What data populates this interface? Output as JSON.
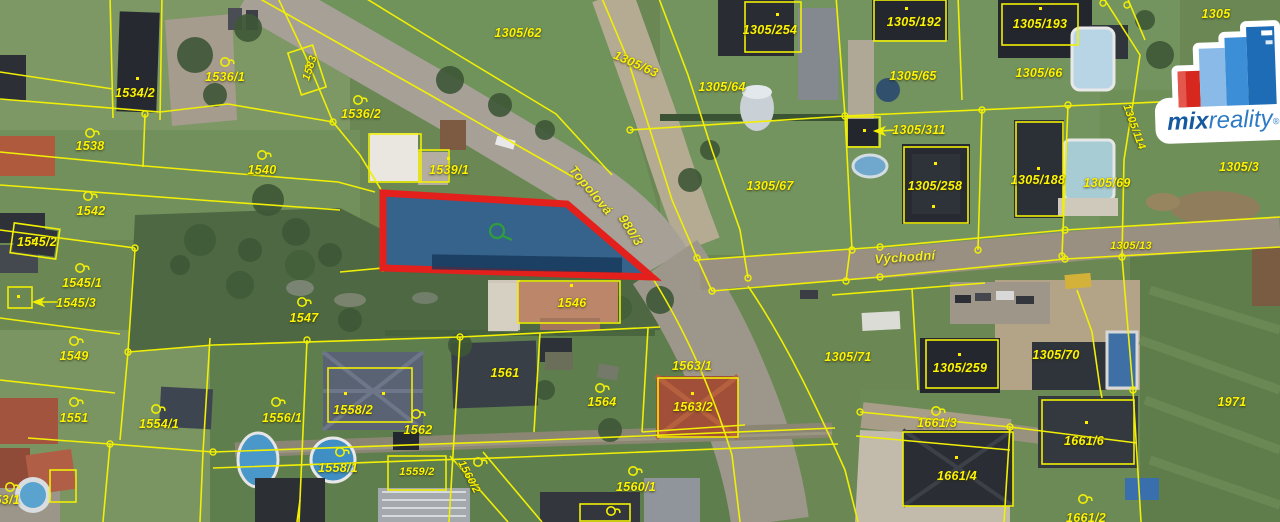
{
  "map": {
    "description": "Aerial cadastral map with parcel boundaries and one highlighted parcel",
    "highlighted_parcel": {
      "border_color": "#e3201b",
      "fill_color": "#2e5f93",
      "marker_color": "#2f9e3c"
    },
    "colors": {
      "parcel_line": "#f0ef05",
      "label": "#fdf304"
    },
    "street_names": [
      "Topolová",
      "Východní"
    ],
    "labels": [
      {
        "text": "1534/2",
        "x": 135,
        "y": 93
      },
      {
        "text": "1536/1",
        "x": 225,
        "y": 77
      },
      {
        "text": "1536/2",
        "x": 361,
        "y": 114
      },
      {
        "text": "1583",
        "x": 310,
        "y": 68,
        "rot": -72,
        "size": 11
      },
      {
        "text": "1538",
        "x": 90,
        "y": 146
      },
      {
        "text": "1540",
        "x": 262,
        "y": 170
      },
      {
        "text": "1542",
        "x": 91,
        "y": 211
      },
      {
        "text": "1545/2",
        "x": 37,
        "y": 242
      },
      {
        "text": "1545/1",
        "x": 82,
        "y": 283
      },
      {
        "text": "1545/3",
        "x": 76,
        "y": 303
      },
      {
        "text": "1549",
        "x": 74,
        "y": 356
      },
      {
        "text": "1551",
        "x": 74,
        "y": 418
      },
      {
        "text": "1554/1",
        "x": 159,
        "y": 424
      },
      {
        "text": "1553/1",
        "x": 0,
        "y": 500
      },
      {
        "text": "1556/1",
        "x": 282,
        "y": 418
      },
      {
        "text": "1558/2",
        "x": 353,
        "y": 410
      },
      {
        "text": "1558/1",
        "x": 338,
        "y": 468
      },
      {
        "text": "1562",
        "x": 418,
        "y": 430
      },
      {
        "text": "1561",
        "x": 505,
        "y": 373
      },
      {
        "text": "1559/2",
        "x": 417,
        "y": 472,
        "size": 11
      },
      {
        "text": "1560/2",
        "x": 469,
        "y": 477,
        "rot": 62,
        "size": 11
      },
      {
        "text": "1560/1",
        "x": 636,
        "y": 487
      },
      {
        "text": "1564",
        "x": 602,
        "y": 402
      },
      {
        "text": "1563/1",
        "x": 692,
        "y": 366
      },
      {
        "text": "1563/2",
        "x": 693,
        "y": 407
      },
      {
        "text": "1546",
        "x": 572,
        "y": 303
      },
      {
        "text": "1547",
        "x": 304,
        "y": 318
      },
      {
        "text": "1539/1",
        "x": 449,
        "y": 170
      },
      {
        "text": "1305/62",
        "x": 518,
        "y": 33
      },
      {
        "text": "1305/63",
        "x": 636,
        "y": 64,
        "rot": 24
      },
      {
        "text": "1305/254",
        "x": 770,
        "y": 30
      },
      {
        "text": "1305/192",
        "x": 914,
        "y": 22
      },
      {
        "text": "1305/64",
        "x": 722,
        "y": 87
      },
      {
        "text": "1305/65",
        "x": 913,
        "y": 76
      },
      {
        "text": "1305/311",
        "x": 919,
        "y": 130
      },
      {
        "text": "1305/193",
        "x": 1040,
        "y": 24
      },
      {
        "text": "1305/66",
        "x": 1039,
        "y": 73
      },
      {
        "text": "1305",
        "x": 1216,
        "y": 14
      },
      {
        "text": "1305/67",
        "x": 770,
        "y": 186
      },
      {
        "text": "1305/258",
        "x": 935,
        "y": 186
      },
      {
        "text": "1305/188",
        "x": 1038,
        "y": 180
      },
      {
        "text": "1305/69",
        "x": 1107,
        "y": 183
      },
      {
        "text": "1305/3",
        "x": 1239,
        "y": 167
      },
      {
        "text": "1305/13",
        "x": 1131,
        "y": 246,
        "size": 11
      },
      {
        "text": "1305/114",
        "x": 1134,
        "y": 127,
        "rot": 70,
        "size": 11
      },
      {
        "text": "1305/71",
        "x": 848,
        "y": 357
      },
      {
        "text": "1305/259",
        "x": 960,
        "y": 368
      },
      {
        "text": "1305/70",
        "x": 1056,
        "y": 355
      },
      {
        "text": "1661/3",
        "x": 937,
        "y": 423
      },
      {
        "text": "1661/4",
        "x": 957,
        "y": 476
      },
      {
        "text": "1661/6",
        "x": 1084,
        "y": 441
      },
      {
        "text": "1661/2",
        "x": 1086,
        "y": 518
      },
      {
        "text": "1971",
        "x": 1232,
        "y": 402
      },
      {
        "text": "Topolová",
        "x": 591,
        "y": 190,
        "rot": 50,
        "kind": "street"
      },
      {
        "text": "980/3",
        "x": 631,
        "y": 230,
        "rot": 58,
        "kind": "street"
      },
      {
        "text": "Východní",
        "x": 905,
        "y": 257,
        "rot": -4,
        "kind": "street"
      }
    ]
  },
  "logo": {
    "brand_bold": "mix",
    "brand_light": "reality",
    "registered": "®",
    "brand_dark_blue": "#15599f",
    "brand_blue": "#2e7bc4",
    "brand_red": "#d6281e"
  }
}
